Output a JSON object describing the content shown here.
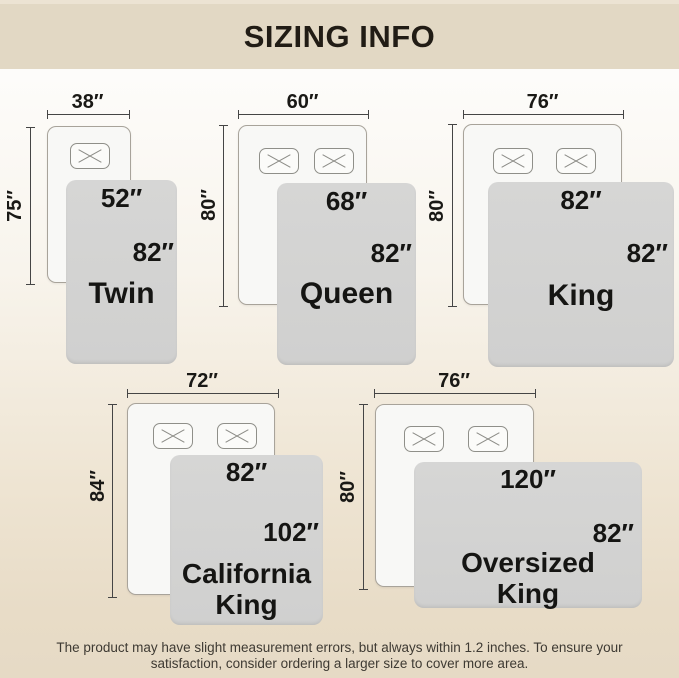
{
  "header": {
    "title": "SIZING INFO"
  },
  "diagrams": [
    {
      "name": "Twin",
      "bed_width": "38″",
      "bed_length": "75″",
      "blanket_width": "52″",
      "blanket_length": "82″",
      "pillow_count": 1
    },
    {
      "name": "Queen",
      "bed_width": "60″",
      "bed_length": "80″",
      "blanket_width": "68″",
      "blanket_length": "82″",
      "pillow_count": 2
    },
    {
      "name": "King",
      "bed_width": "76″",
      "bed_length": "80″",
      "blanket_width": "82″",
      "blanket_length": "82″",
      "pillow_count": 2
    },
    {
      "name": "California King",
      "bed_width": "72″",
      "bed_length": "84″",
      "blanket_width": "82″",
      "blanket_length": "102″",
      "pillow_count": 2
    },
    {
      "name": "Oversized King",
      "bed_width": "76″",
      "bed_length": "80″",
      "blanket_width": "120″",
      "blanket_length": "82″",
      "pillow_count": 2
    }
  ],
  "footer": {
    "note": "The product may have slight measurement errors, but always within 1.2 inches. To ensure your satisfaction, consider ordering a larger size to cover more area."
  },
  "colors": {
    "header_bg": "#e2d8c4",
    "page_top": "#fdfcfa",
    "page_bottom": "#e6dac5",
    "blanket": "#d3d3d2",
    "bed": "#f8f8f6",
    "dimension_line": "#454545",
    "text": "#151513"
  }
}
